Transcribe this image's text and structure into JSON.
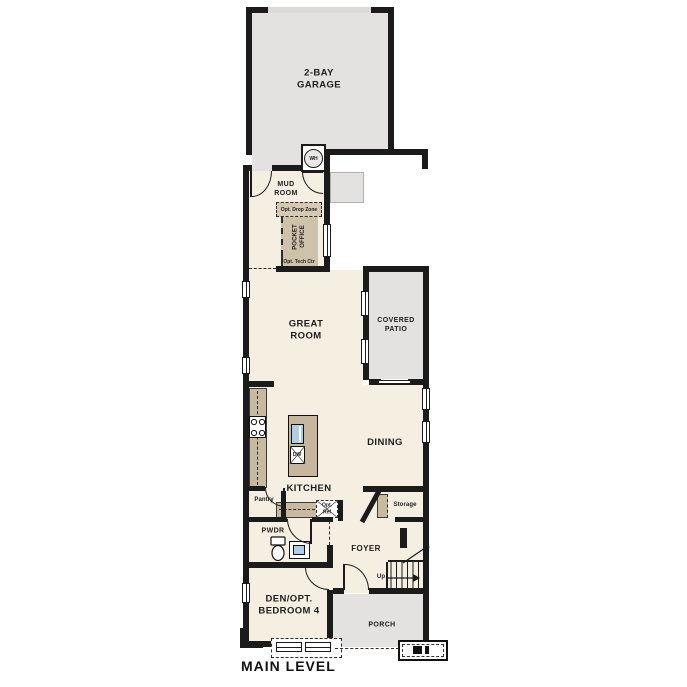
{
  "title": "MAIN LEVEL",
  "labels": {
    "garage": "2-BAY\nGARAGE",
    "mud_room": "MUD\nROOM",
    "opt_drop_zone": "Opt. Drop Zone",
    "pocket_office": "POCKET\nOFFICE",
    "opt_tech_ctr": "Opt. Tech Ctr",
    "great_room": "GREAT\nROOM",
    "covered_patio": "COVERED\nPATIO",
    "dining": "DINING",
    "kitchen": "KITCHEN",
    "pantry": "Pantry",
    "opt_ref": "Opt.\nRef",
    "storage": "Storage",
    "pwdr": "PWDR",
    "foyer": "FOYER",
    "den": "DEN/OPT.\nBEDROOM 4",
    "porch": "PORCH",
    "up": "Up",
    "main_level": "MAIN LEVEL"
  },
  "fixtures": {
    "water_heater": "WH",
    "dishwasher": "DW"
  },
  "colors": {
    "wall": "#1b1b1b",
    "room_fill": "#f5efe2",
    "exterior_fill": "#e3e2e0",
    "casework_fill": "#c8baa0",
    "office_fill": "#cfc2aa",
    "sink_fill": "#aecde8"
  }
}
